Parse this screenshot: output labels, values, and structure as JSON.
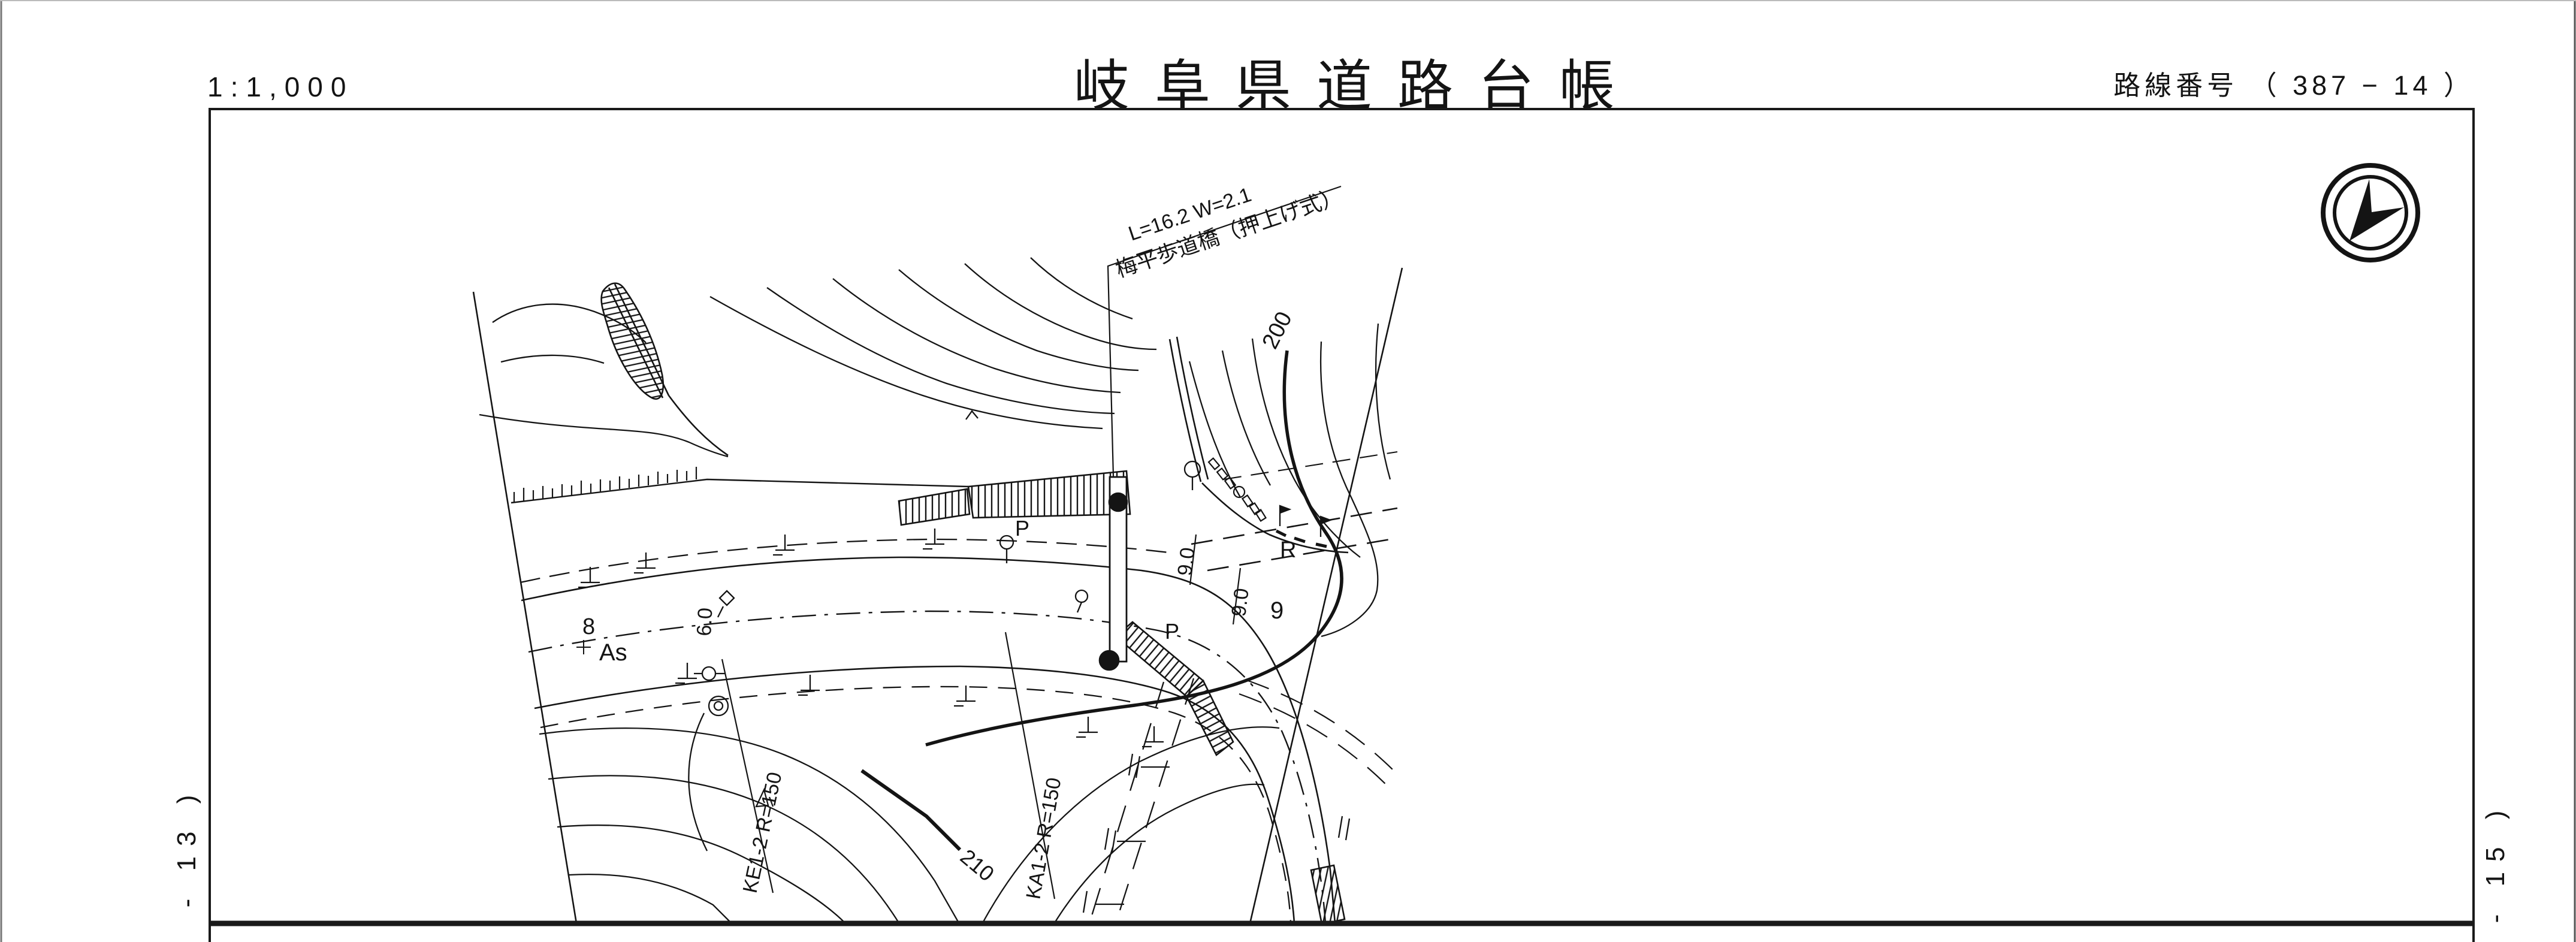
{
  "colors": {
    "ink": "#141414",
    "paper": "#ffffff"
  },
  "header": {
    "scale": "1:1,000",
    "title": "岐阜県道路台帳",
    "route": "路線番号 （ 387 −  14 ）"
  },
  "side_labels": {
    "left": "- 13 )",
    "right": "- 15 )"
  },
  "icons": {
    "compass": "north-arrow"
  },
  "map": {
    "labels": {
      "bridge_dim": "L=16.2 W=2.1",
      "bridge_name": "梅平歩道橋（押上げ式）",
      "contour_200": "200",
      "contour_210": "210",
      "curve_ke": "KE1-2 R=150",
      "curve_ka": "KA1-2 R=150",
      "width_6": "6.0",
      "width_9a": "9.0",
      "width_9b": "9.0",
      "station_8": "8",
      "surface_as": "As",
      "station_9": "9",
      "radius_r": "R",
      "pole_p1": "P",
      "pole_p2": "P"
    }
  }
}
